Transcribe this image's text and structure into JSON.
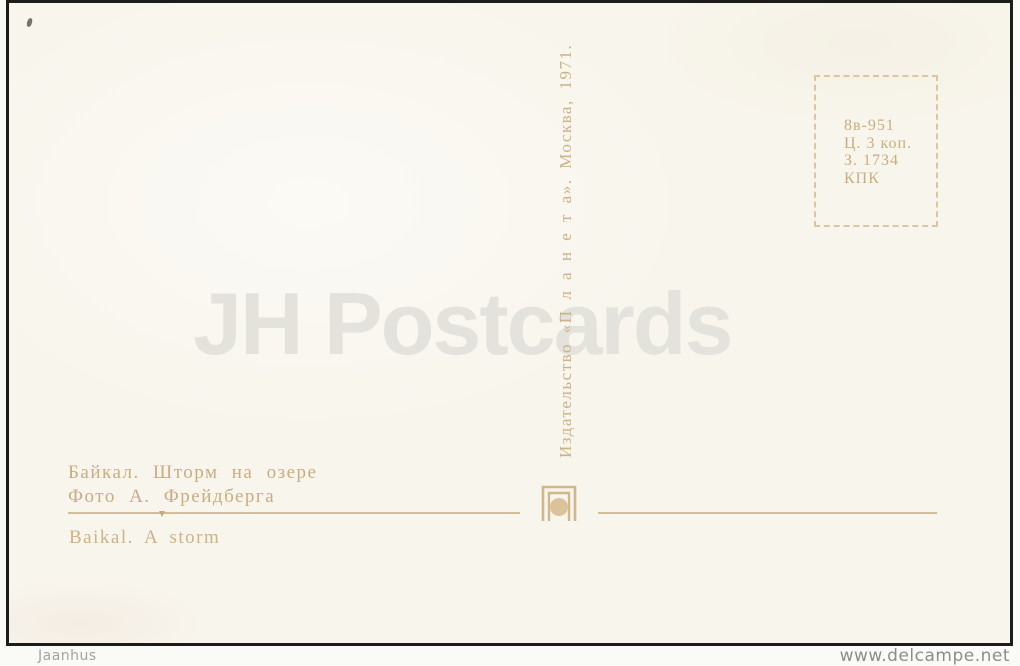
{
  "postcard": {
    "watermark": "JH Postcards",
    "stamp_box": {
      "lines": [
        "8в-951",
        "Ц. 3 коп.",
        "З. 1734",
        "КПК"
      ]
    },
    "publisher_imprint_vertical": "Издательство «П л а н е т а».  Москва, 1971.",
    "captions": {
      "title_ru": "Байкал. Шторм на озере",
      "photo_credit_ru": "Фото А. Фрейдберга",
      "title_en": "Baikal. A storm"
    },
    "logo_name": "planeta-publisher-logo"
  },
  "footer": {
    "seller": "Jaanhus",
    "site": "www.delcampe.net"
  },
  "colors": {
    "paper": "#f8f5ec",
    "ink": "#c9ad80",
    "stamp_ink": "#c9ae7f",
    "watermark": "#e4e2dd",
    "scan_border": "#1c1c1a",
    "footer_text": "#8d8d8a"
  }
}
